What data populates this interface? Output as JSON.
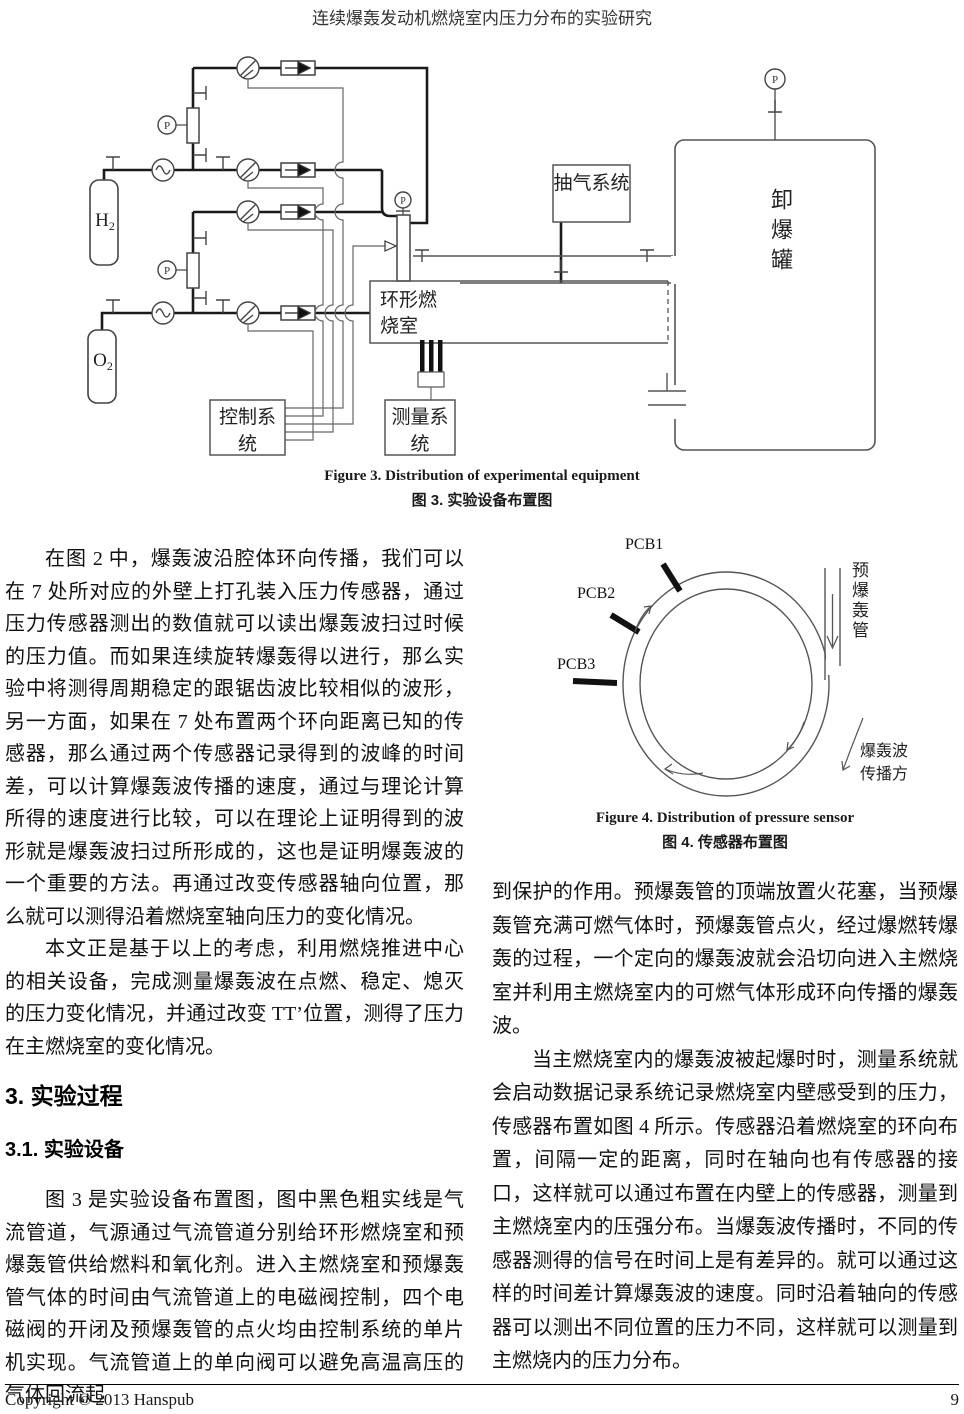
{
  "header": {
    "title": "连续爆轰发动机燃烧室内压力分布的实验研究"
  },
  "figure3": {
    "caption_en": "Figure 3. Distribution of experimental equipment",
    "caption_zh": "图 3.  实验设备布置图",
    "labels": {
      "h2_main": "H",
      "h2_sub": "2",
      "o2_main": "O",
      "o2_sub": "2",
      "pump_system": "抽气系统",
      "annular_chamber": "环形燃烧室",
      "discharge_tank": "卸爆罐",
      "control_system": "控制系统",
      "measure_system": "测量系统",
      "pressure_gauge": "P"
    }
  },
  "figure4": {
    "caption_en": "Figure 4. Distribution of pressure sensor",
    "caption_zh": "图 4.  传感器布置图",
    "labels": {
      "pcb1": "PCB1",
      "pcb2": "PCB2",
      "pcb3": "PCB3",
      "predet_tube": "预爆轰管",
      "wave_direction": "爆轰波传播方"
    }
  },
  "left_column": {
    "para1": "在图 2 中，爆轰波沿腔体环向传播，我们可以在 7 处所对应的外壁上打孔装入压力传感器，通过压力传感器测出的数值就可以读出爆轰波扫过时候的压力值。而如果连续旋转爆轰得以进行，那么实验中将测得周期稳定的跟锯齿波比较相似的波形，另一方面，如果在 7 处布置两个环向距离已知的传感器，那么通过两个传感器记录得到的波峰的时间差，可以计算爆轰波传播的速度，通过与理论计算所得的速度进行比较，可以在理论上证明得到的波形就是爆轰波扫过所形成的，这也是证明爆轰波的一个重要的方法。再通过改变传感器轴向位置，那么就可以测得沿着燃烧室轴向压力的变化情况。",
    "para2": "本文正是基于以上的考虑，利用燃烧推进中心的相关设备，完成测量爆轰波在点燃、稳定、熄灭的压力变化情况，并通过改变 TT’位置，测得了压力在主燃烧室的变化情况。",
    "heading_section": "3. 实验过程",
    "heading_sub": "3.1. 实验设备",
    "para3": "图 3 是实验设备布置图，图中黑色粗实线是气流管道，气源通过气流管道分别给环形燃烧室和预爆轰管供给燃料和氧化剂。进入主燃烧室和预爆轰管气体的时间由气流管道上的电磁阀控制，四个电磁阀的开闭及预爆轰管的点火均由控制系统的单片机实现。气流管道上的单向阀可以避免高温高压的气体回流起"
  },
  "right_column": {
    "para1": "到保护的作用。预爆轰管的顶端放置火花塞，当预爆轰管充满可燃气体时，预爆轰管点火，经过爆燃转爆轰的过程，一个定向的爆轰波就会沿切向进入主燃烧室并利用主燃烧室内的可燃气体形成环向传播的爆轰波。",
    "para2": "当主燃烧室内的爆轰波被起爆时时，测量系统就会启动数据记录系统记录燃烧室内壁感受到的压力，传感器布置如图 4 所示。传感器沿着燃烧室的环向布置，间隔一定的距离，同时在轴向也有传感器的接口，这样就可以通过布置在内壁上的传感器，测量到主燃烧室内的压强分布。当爆轰波传播时，不同的传感器测得的信号在时间上是有差异的。就可以通过这样的时间差计算爆轰波的速度。同时沿着轴向的传感器可以测出不同位置的压力不同，这样就可以测量到主燃烧内的压力分布。"
  },
  "footer": {
    "copyright": "Copyright © 2013 Hanspub",
    "page_number": "9"
  }
}
